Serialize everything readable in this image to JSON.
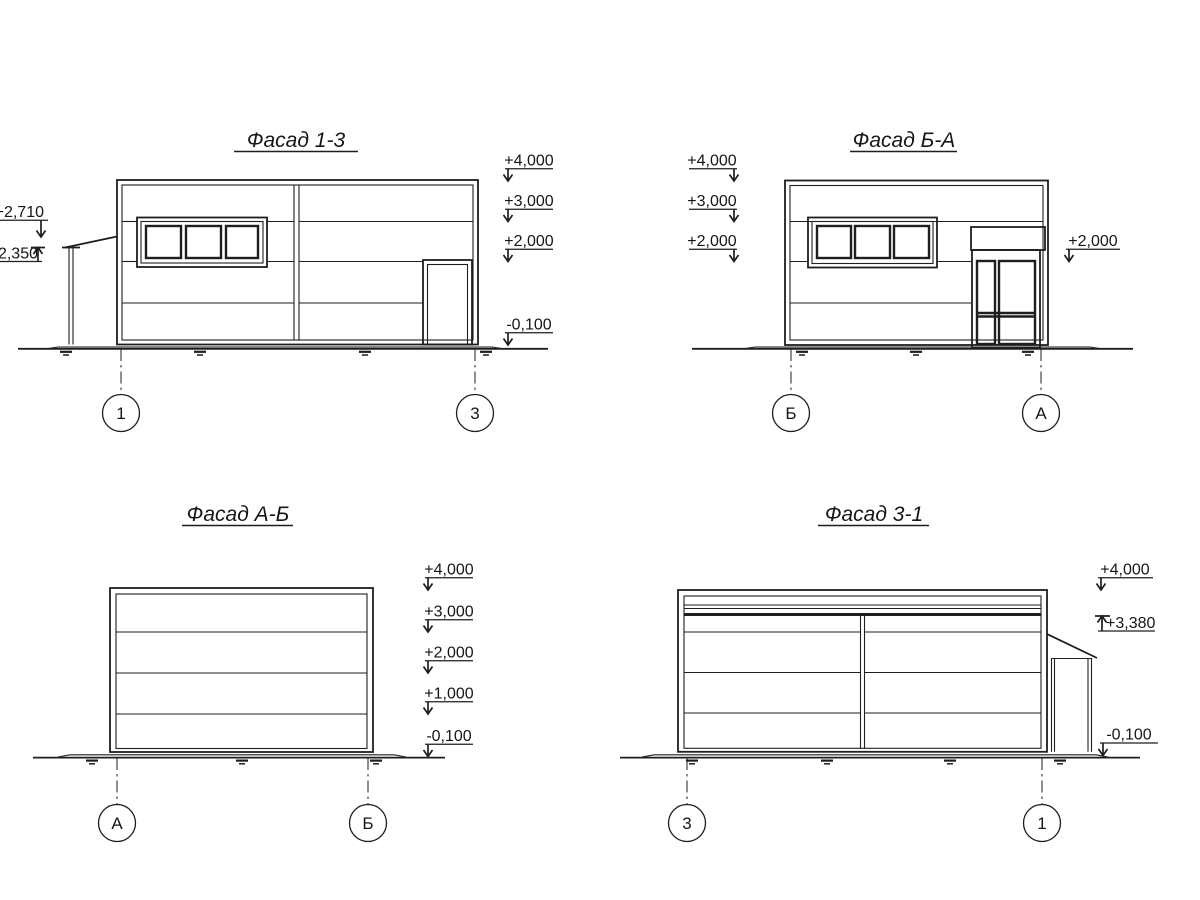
{
  "drawing": {
    "facade_13": {
      "title": "Фасад 1-3",
      "elevation_marks": {
        "left": [
          "+2,710",
          "2,350"
        ],
        "right": [
          "+4,000",
          "+3,000",
          "+2,000",
          "-0,100"
        ]
      },
      "grid_bubbles": [
        "1",
        "3"
      ]
    },
    "facade_ba": {
      "title": "Фасад Б-А",
      "elevation_marks": {
        "left": [
          "+4,000",
          "+3,000",
          "+2,000"
        ],
        "right": [
          "+2,000"
        ]
      },
      "grid_bubbles": [
        "Б",
        "А"
      ]
    },
    "facade_ab": {
      "title": "Фасад А-Б",
      "elevation_marks": {
        "right": [
          "+4,000",
          "+3,000",
          "+2,000",
          "+1,000",
          "-0,100"
        ]
      },
      "grid_bubbles": [
        "А",
        "Б"
      ]
    },
    "facade_31": {
      "title": "Фасад 3-1",
      "elevation_marks": {
        "right": [
          "+4,000",
          "+3,380",
          "-0,100"
        ]
      },
      "grid_bubbles": [
        "3",
        "1"
      ]
    },
    "colors": {
      "line": "#1e1e1e",
      "background": "#ffffff"
    }
  }
}
